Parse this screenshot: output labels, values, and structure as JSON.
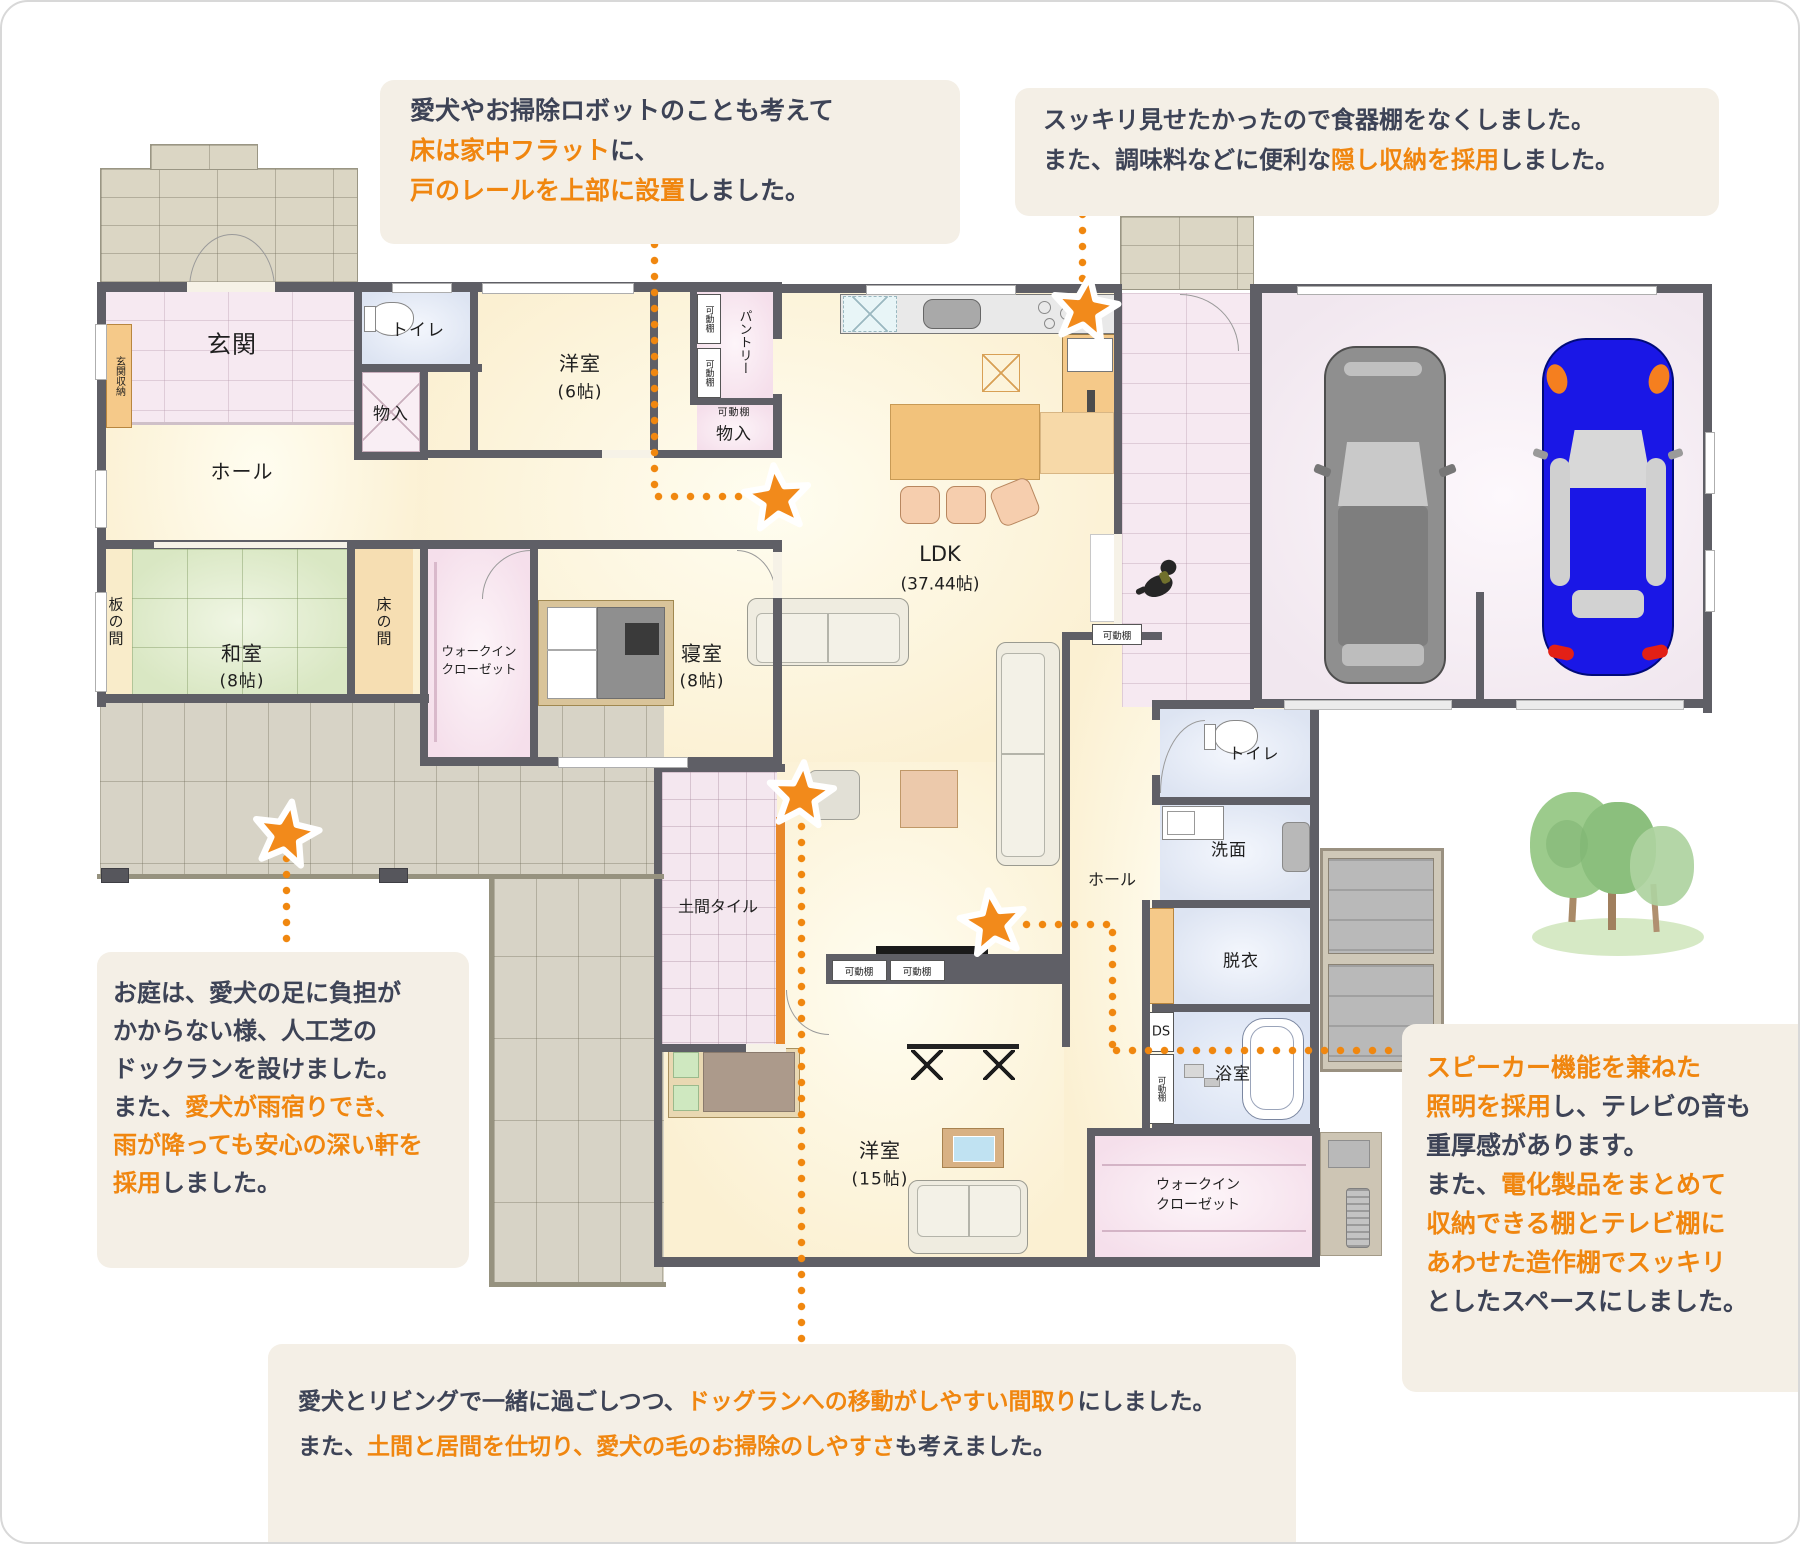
{
  "colors": {
    "accent_orange": "#f0860f",
    "text_dark": "#3d4356",
    "annotation_bg": "#f4efe6",
    "wall": "#5f5f66",
    "tatami_green": "#d9e7c3",
    "car_blue": "#1a17e6"
  },
  "annotations": {
    "top_left": {
      "lines": [
        [
          {
            "t": "愛犬やお掃除ロボットのことも考えて",
            "c": "dark"
          }
        ],
        [
          {
            "t": "床は家中フラット",
            "c": "orange"
          },
          {
            "t": "に、",
            "c": "dark"
          }
        ],
        [
          {
            "t": "戸のレールを上部に設置",
            "c": "orange"
          },
          {
            "t": "しました。",
            "c": "dark"
          }
        ]
      ]
    },
    "top_right": {
      "lines": [
        [
          {
            "t": "スッキリ見せたかったので食器棚をなくしました。",
            "c": "dark"
          }
        ],
        [
          {
            "t": "また、調味料などに便利な",
            "c": "dark"
          },
          {
            "t": "隠し収納を採用",
            "c": "orange"
          },
          {
            "t": "しました。",
            "c": "dark"
          }
        ]
      ]
    },
    "garden": {
      "lines": [
        [
          {
            "t": "お庭は、愛犬の足に負担が",
            "c": "dark"
          }
        ],
        [
          {
            "t": "かからない様、人工芝の",
            "c": "dark"
          }
        ],
        [
          {
            "t": "ドックランを設けました。",
            "c": "dark"
          }
        ],
        [
          {
            "t": "また、",
            "c": "dark"
          },
          {
            "t": "愛犬が雨宿りでき、",
            "c": "orange"
          }
        ],
        [
          {
            "t": "雨が降っても安心の深い軒を",
            "c": "orange"
          }
        ],
        [
          {
            "t": "採用",
            "c": "orange"
          },
          {
            "t": "しました。",
            "c": "dark"
          }
        ]
      ]
    },
    "speaker": {
      "lines": [
        [
          {
            "t": "スピーカー機能を兼ねた",
            "c": "orange"
          }
        ],
        [
          {
            "t": "照明を採用",
            "c": "orange"
          },
          {
            "t": "し、テレビの音も",
            "c": "dark"
          }
        ],
        [
          {
            "t": "重厚感があります。",
            "c": "dark"
          }
        ],
        [
          {
            "t": "また、",
            "c": "dark"
          },
          {
            "t": "電化製品をまとめて",
            "c": "orange"
          }
        ],
        [
          {
            "t": "収納できる棚とテレビ棚に",
            "c": "orange"
          }
        ],
        [
          {
            "t": "あわせた造作棚でスッキリ",
            "c": "orange"
          }
        ],
        [
          {
            "t": "としたスペースにしました。",
            "c": "dark"
          }
        ]
      ]
    },
    "bottom": {
      "lines": [
        [
          {
            "t": "愛犬とリビングで一緒に過ごしつつ、",
            "c": "dark"
          },
          {
            "t": "ドッグランへの移動がしやすい間取り",
            "c": "orange"
          },
          {
            "t": "にしました。",
            "c": "dark"
          }
        ],
        [
          {
            "t": "また、",
            "c": "dark"
          },
          {
            "t": "土間と居間を仕切り、愛犬の毛のお掃除のしやすさ",
            "c": "orange"
          },
          {
            "t": "も考えました。",
            "c": "dark"
          }
        ]
      ]
    }
  },
  "plan": {
    "labels": {
      "genkan": "玄関",
      "genkan_storage": "玄関収納",
      "hall": "ホール",
      "toilet": "トイレ",
      "mono_iri": "物入",
      "youshitsu": "洋室",
      "youshitsu6_size": "(6帖)",
      "pantry": "パントリー",
      "kadoudana": "可動棚",
      "ldk": "LDK",
      "ldk_size": "(37.44帖)",
      "itanoma": "板の間",
      "washitsu": "和室",
      "washitsu_size": "(8帖)",
      "tokonoma": "床の間",
      "walkin_line1": "ウォークイン",
      "walkin_line2": "クローゼット",
      "shinshitsu": "寝室",
      "shinshitsu_size": "(8帖)",
      "doma_tile": "土間タイル",
      "senmen": "洗面",
      "datsui": "脱衣",
      "bath": "浴室",
      "ds": "DS",
      "youshitsu15_size": "(15帖)"
    }
  }
}
